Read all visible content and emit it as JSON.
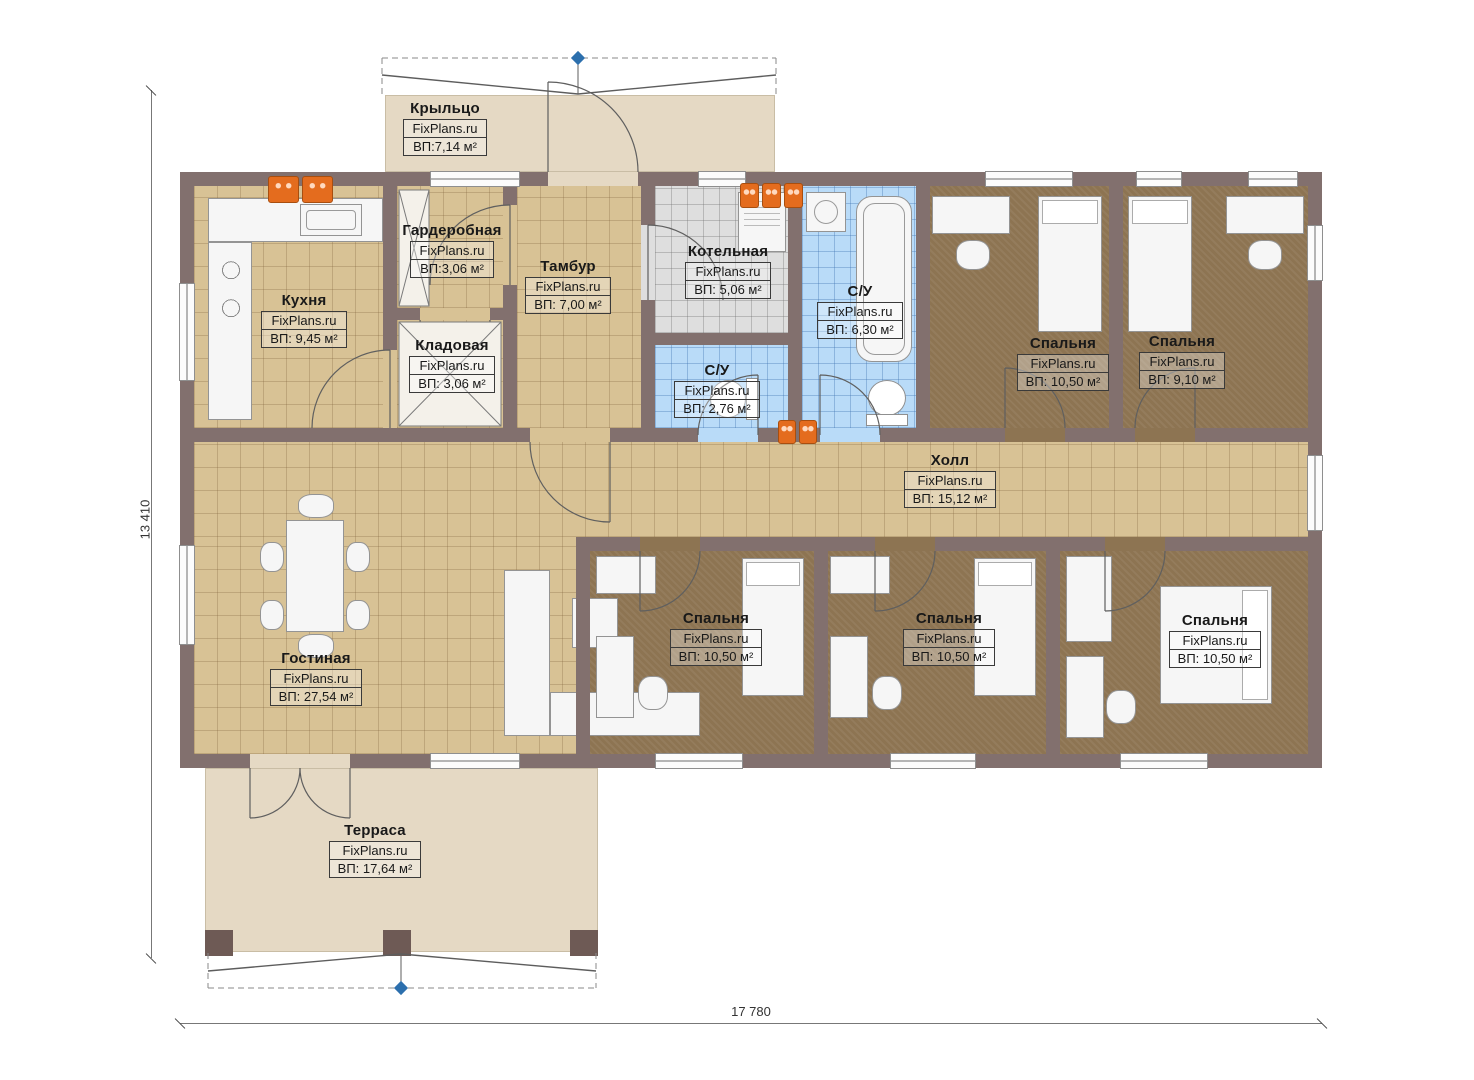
{
  "palette": {
    "wall": "#82706e",
    "floor_tile_tan": "#d8c295",
    "floor_carpet_brown": "#8d7452",
    "floor_tile_blue": "#b9dbf8",
    "floor_tile_grey": "#dedede",
    "terrace_beige": "#e5d9c4",
    "radiator_orange": "#e46c1e",
    "marker_blue": "#2c6fad"
  },
  "dimensions": {
    "vertical_label": "13 410",
    "horizontal_label": "17 780"
  },
  "rooms": [
    {
      "name": "Крыльцо",
      "site": "FixPlans.ru",
      "area": "ВП:7,14 м²"
    },
    {
      "name": "Гардеробная",
      "site": "FixPlans.ru",
      "area": "ВП:3,06 м²"
    },
    {
      "name": "Тамбур",
      "site": "FixPlans.ru",
      "area": "ВП: 7,00 м²"
    },
    {
      "name": "Котельная",
      "site": "FixPlans.ru",
      "area": "ВП: 5,06 м²"
    },
    {
      "name": "С/У",
      "site": "FixPlans.ru",
      "area": "ВП: 6,30 м²"
    },
    {
      "name": "Кухня",
      "site": "FixPlans.ru",
      "area": "ВП: 9,45 м²"
    },
    {
      "name": "Кладовая",
      "site": "FixPlans.ru",
      "area": "ВП: 3,06 м²"
    },
    {
      "name": "С/У",
      "site": "FixPlans.ru",
      "area": "ВП: 2,76 м²"
    },
    {
      "name": "Спальня",
      "site": "FixPlans.ru",
      "area": "ВП: 10,50 м²"
    },
    {
      "name": "Спальня",
      "site": "FixPlans.ru",
      "area": "ВП: 9,10 м²"
    },
    {
      "name": "Холл",
      "site": "FixPlans.ru",
      "area": "ВП: 15,12 м²"
    },
    {
      "name": "Гостиная",
      "site": "FixPlans.ru",
      "area": "ВП: 27,54 м²"
    },
    {
      "name": "Спальня",
      "site": "FixPlans.ru",
      "area": "ВП: 10,50 м²"
    },
    {
      "name": "Спальня",
      "site": "FixPlans.ru",
      "area": "ВП: 10,50 м²"
    },
    {
      "name": "Спальня",
      "site": "FixPlans.ru",
      "area": "ВП: 10,50 м²"
    },
    {
      "name": "Терраса",
      "site": "FixPlans.ru",
      "area": "ВП: 17,64 м²"
    }
  ]
}
